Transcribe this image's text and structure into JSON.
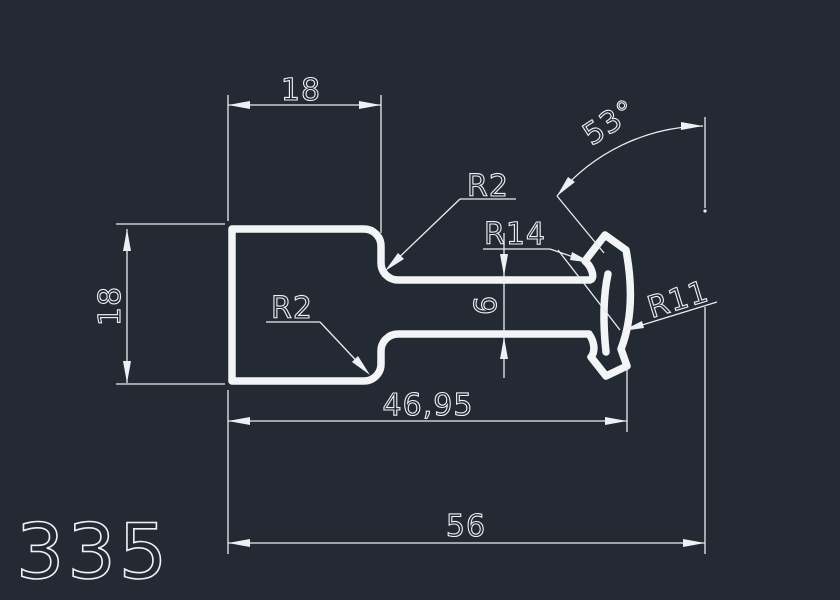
{
  "drawing": {
    "sheet_number": "335",
    "background_color": "#242a33",
    "line_color": "#f2f4f6",
    "dim_line_color": "#e9edf0",
    "dimensions": {
      "top_width": "18",
      "left_height": "18",
      "neck_thickness": "6",
      "head_angle": "53°",
      "length_to_head": "46,95",
      "overall_length": "56"
    },
    "radii": {
      "top_fillet": "R2",
      "bottom_fillet": "R2",
      "inner_arc": "R14",
      "outer_arc": "R11"
    }
  }
}
